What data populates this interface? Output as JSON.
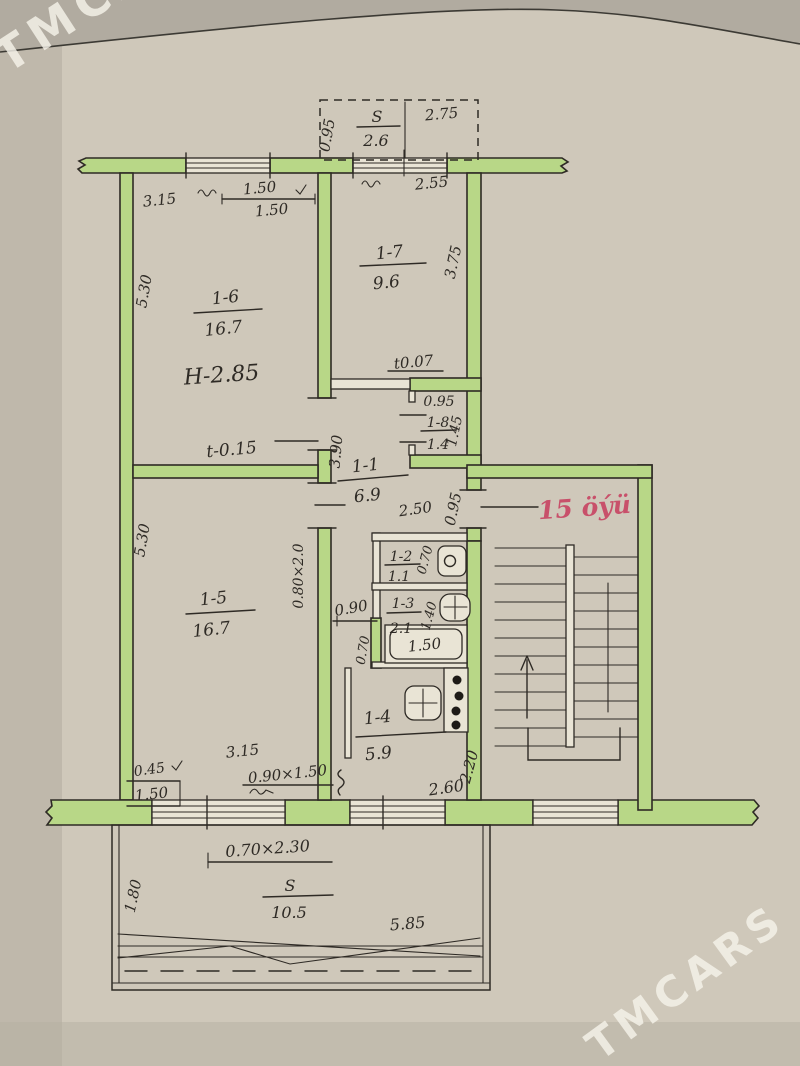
{
  "watermark": "TMCARS",
  "colors": {
    "paper": "#cfc8ba",
    "paper_dark": "#b1aba0",
    "wall_green": "#b8d787",
    "ink": "#2e2a25",
    "red_accent": "#c8506a"
  },
  "plan": {
    "unit_label": "15 öýü",
    "balcony_top": {
      "s": "S",
      "area": "2.6",
      "width": "2.75",
      "depth": "0.95"
    },
    "top": {
      "wall_left": "3.15",
      "window_top": "1.50",
      "window_bottom": "1.50",
      "window_right": "2.55"
    },
    "room_1_6": {
      "num": "1-6",
      "area": "16.7",
      "ceiling": "H-2.85",
      "level": "t-0.15",
      "side": "5.30"
    },
    "room_1_7": {
      "num": "1-7",
      "area": "9.6",
      "side": "3.75",
      "level": "t0.07"
    },
    "closet_1_8": {
      "num": "1-8",
      "area": "1.4",
      "width": "0.95",
      "depth": "1.45"
    },
    "hall_1_1": {
      "num": "1-1",
      "area": "6.9",
      "length": "3.90",
      "width": "2.50",
      "entry_door": "0.95"
    },
    "wc_1_2": {
      "num": "1-2",
      "area": "1.1",
      "door": "0.70"
    },
    "bath_1_3": {
      "num": "1-3",
      "area": "2.1",
      "width": "1.40",
      "door": "0.90",
      "tub": "1.50",
      "tub_side": "0.70"
    },
    "kitchen_1_4": {
      "num": "1-4",
      "area": "5.9",
      "width": "2.60",
      "depth": "2.20"
    },
    "room_1_5": {
      "num": "1-5",
      "area": "16.7",
      "side": "5.30",
      "door": "0.80×2.0",
      "wall": "3.15",
      "niche": "0.45",
      "window_w": "1.50",
      "window": "0.90×1.50"
    },
    "balcony_door": "0.70×2.30",
    "balcony_bottom": {
      "s": "S",
      "area": "10.5",
      "length": "5.85",
      "depth": "1.80"
    }
  }
}
